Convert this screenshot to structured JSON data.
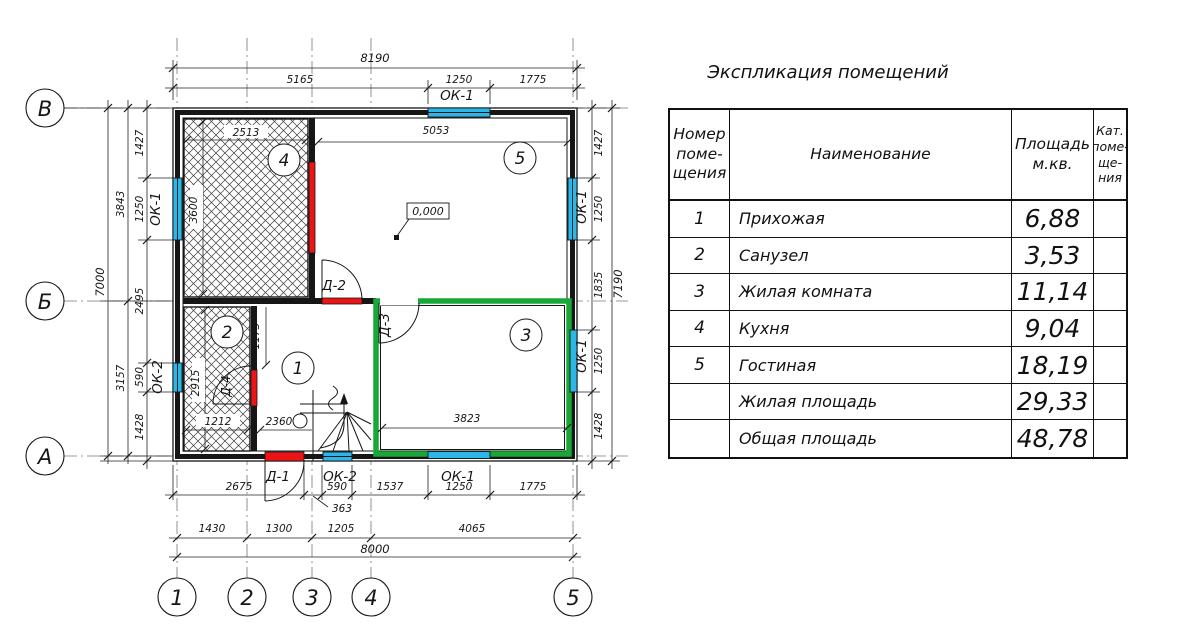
{
  "plan": {
    "axes": {
      "letters": [
        "В",
        "Б",
        "А"
      ],
      "numbers": [
        "1",
        "2",
        "3",
        "4",
        "5"
      ]
    },
    "room_markers": {
      "kitchen": "4",
      "living_room": "5",
      "bathroom": "2",
      "hallway": "1",
      "room3": "3"
    },
    "elevation": "0,000",
    "openings": {
      "ok1": "ОК-1",
      "ok2": "ОК-2",
      "d1": "Д-1",
      "d2": "Д-2",
      "d3": "Д-3",
      "d4": "Д-4"
    },
    "dims": {
      "top": {
        "total": "8190",
        "segs": [
          "5165",
          "1250",
          "1775"
        ]
      },
      "left": {
        "inner": [
          "1427",
          "1250",
          "2495",
          "590",
          "1428"
        ],
        "mid": [
          "3843",
          "3157"
        ],
        "total": "7000"
      },
      "right": {
        "inner": [
          "1427",
          "1250",
          "1835",
          "1250",
          "1428"
        ],
        "total": "7190"
      },
      "bottom": {
        "inner": [
          "2675",
          "363",
          "590",
          "1537",
          "1250",
          "1775"
        ],
        "grid": [
          "1430",
          "1300",
          "1205",
          "4065"
        ],
        "total": "8000"
      },
      "interior": {
        "room4_w": "2513",
        "room4_h": "3600",
        "room5_w": "5053",
        "room2_h": "2915",
        "room2_w": "1212",
        "hall_h": "1173",
        "hall_w": "2360",
        "room3_w": "3823"
      }
    }
  },
  "table": {
    "title": "Экспликация помещений",
    "headers": [
      "Номер\nпоме-\nщения",
      "Наименование",
      "Площадь\nм.кв.",
      "Кат.\nпоме-\nще-\nния"
    ],
    "rows": [
      {
        "num": "1",
        "name": "Прихожая",
        "area": "6,88",
        "cat": ""
      },
      {
        "num": "2",
        "name": "Санузел",
        "area": "3,53",
        "cat": ""
      },
      {
        "num": "3",
        "name": "Жилая комната",
        "area": "11,14",
        "cat": ""
      },
      {
        "num": "4",
        "name": "Кухня",
        "area": "9,04",
        "cat": ""
      },
      {
        "num": "5",
        "name": "Гостиная",
        "area": "18,19",
        "cat": ""
      },
      {
        "num": "",
        "name": "Жилая площадь",
        "area": "29,33",
        "cat": ""
      },
      {
        "num": "",
        "name": "Общая площадь",
        "area": "48,78",
        "cat": ""
      }
    ]
  },
  "colors": {
    "window_cyan": "#2cb7e8",
    "door_red": "#ec1414",
    "highlight_green": "#17a838"
  }
}
